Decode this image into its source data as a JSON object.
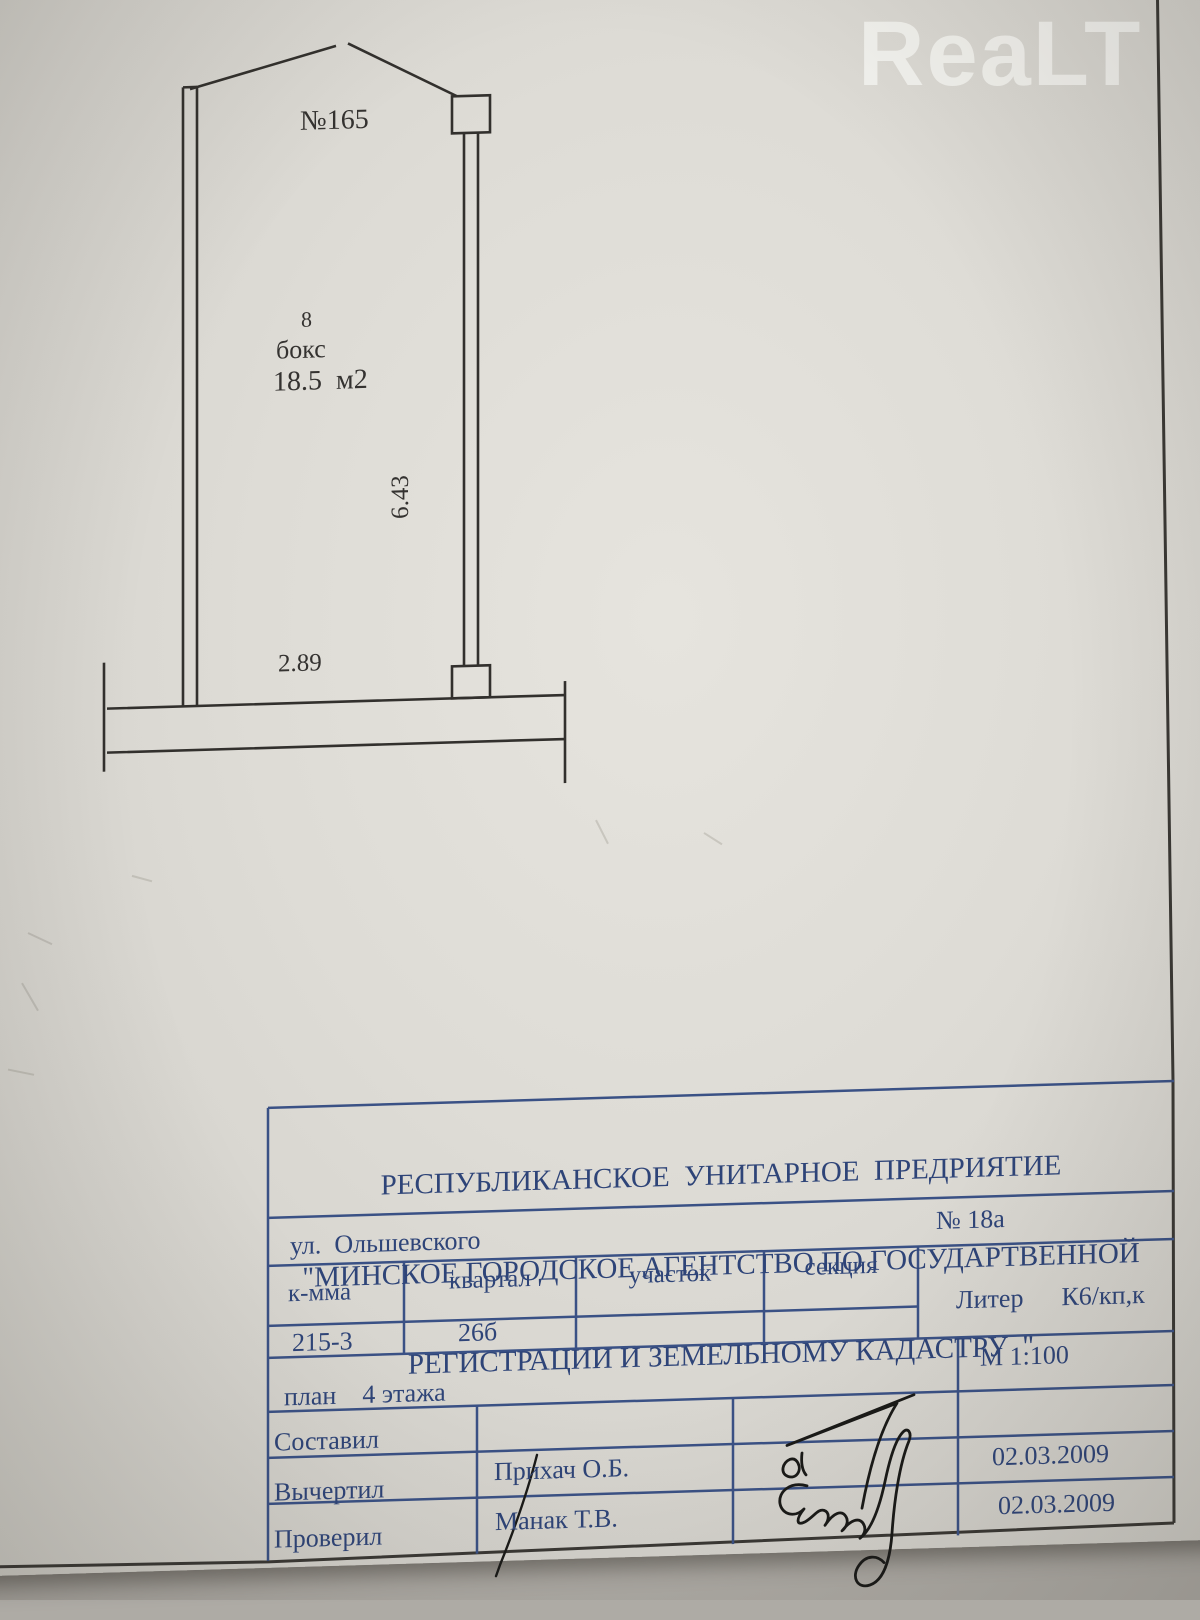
{
  "watermark": {
    "brand": "ReaLT"
  },
  "plan": {
    "unit_number": "№165",
    "room_number": "8",
    "room_type": "бокс",
    "area": "18.5  м2",
    "length": "6.43",
    "width": "2.89"
  },
  "title_block": {
    "org_line1": "РЕСПУБЛИКАНСКОЕ  УНИТАРНОЕ  ПРЕДРИЯТИЕ",
    "org_line2": "\"МИНСКОЕ ГОРОДСКОЕ АГЕНТСТВО ПО ГОСУДАРТВЕННОЙ",
    "org_line3": "РЕГИСТРАЦИИ И ЗЕМЕЛЬНОМУ КАДАСТРУ  \"",
    "street": "ул.  Ольшевского",
    "house_number": "№ 18а",
    "columns": {
      "kmma": "к-мма",
      "kvartal": "квартал",
      "uchastok": "участок",
      "sekciya": "секция"
    },
    "liter_label": "Литер",
    "liter_value": "К6/кп,к",
    "kmma_value": "215-3",
    "kvartal_value": "26б",
    "plan_caption": "план    4 этажа",
    "scale": "М 1:100",
    "row_sostavil": "Составил",
    "row_vychertil": "Вычертил",
    "row_proveril": "Проверил",
    "drafted_by": "Прихач О.Б.",
    "checked_by": "Манак Т.В.",
    "drafted_date": "02.03.2009",
    "checked_date": "02.03.2009"
  },
  "colors": {
    "paper": "#dedbd5",
    "background": "#aeaba5",
    "table_ink": "#2e4478",
    "plan_ink": "#32302d",
    "signature_ink": "#191917",
    "watermark": "#f5f4f1"
  }
}
